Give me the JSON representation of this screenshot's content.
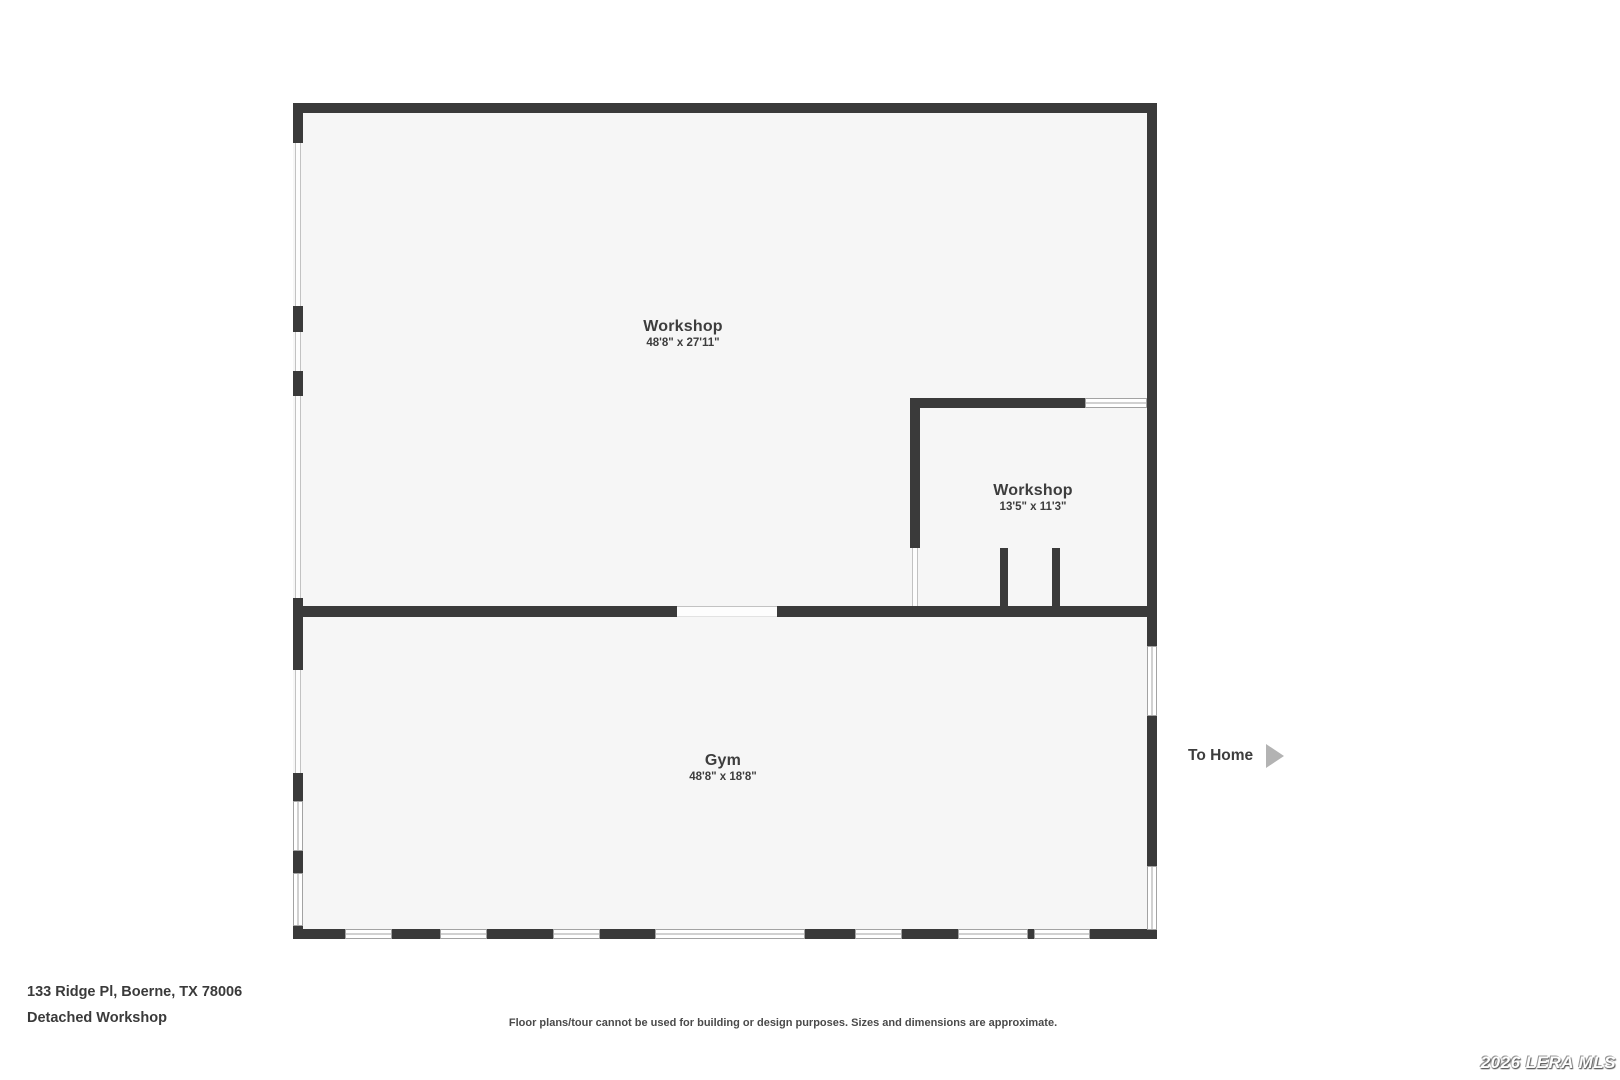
{
  "rooms": [
    {
      "name": "Workshop",
      "dims": "48'8\" x 27'11\""
    },
    {
      "name": "Workshop",
      "dims": "13'5\" x 11'3\""
    },
    {
      "name": "Gym",
      "dims": "48'8\" x 18'8\""
    }
  ],
  "to_home": {
    "label": "To Home"
  },
  "footer": {
    "address": "133 Ridge Pl, Boerne, TX 78006",
    "plan_title": "Detached Workshop",
    "disclaimer": "Floor plans/tour cannot be used for building or design purposes. Sizes and dimensions are approximate.",
    "watermark": "2026 LERA MLS"
  },
  "colors": {
    "wall": "#3a3a3a",
    "floor": "#f6f6f6",
    "text": "#3d3d3d",
    "arrow": "#b3b3b3"
  }
}
